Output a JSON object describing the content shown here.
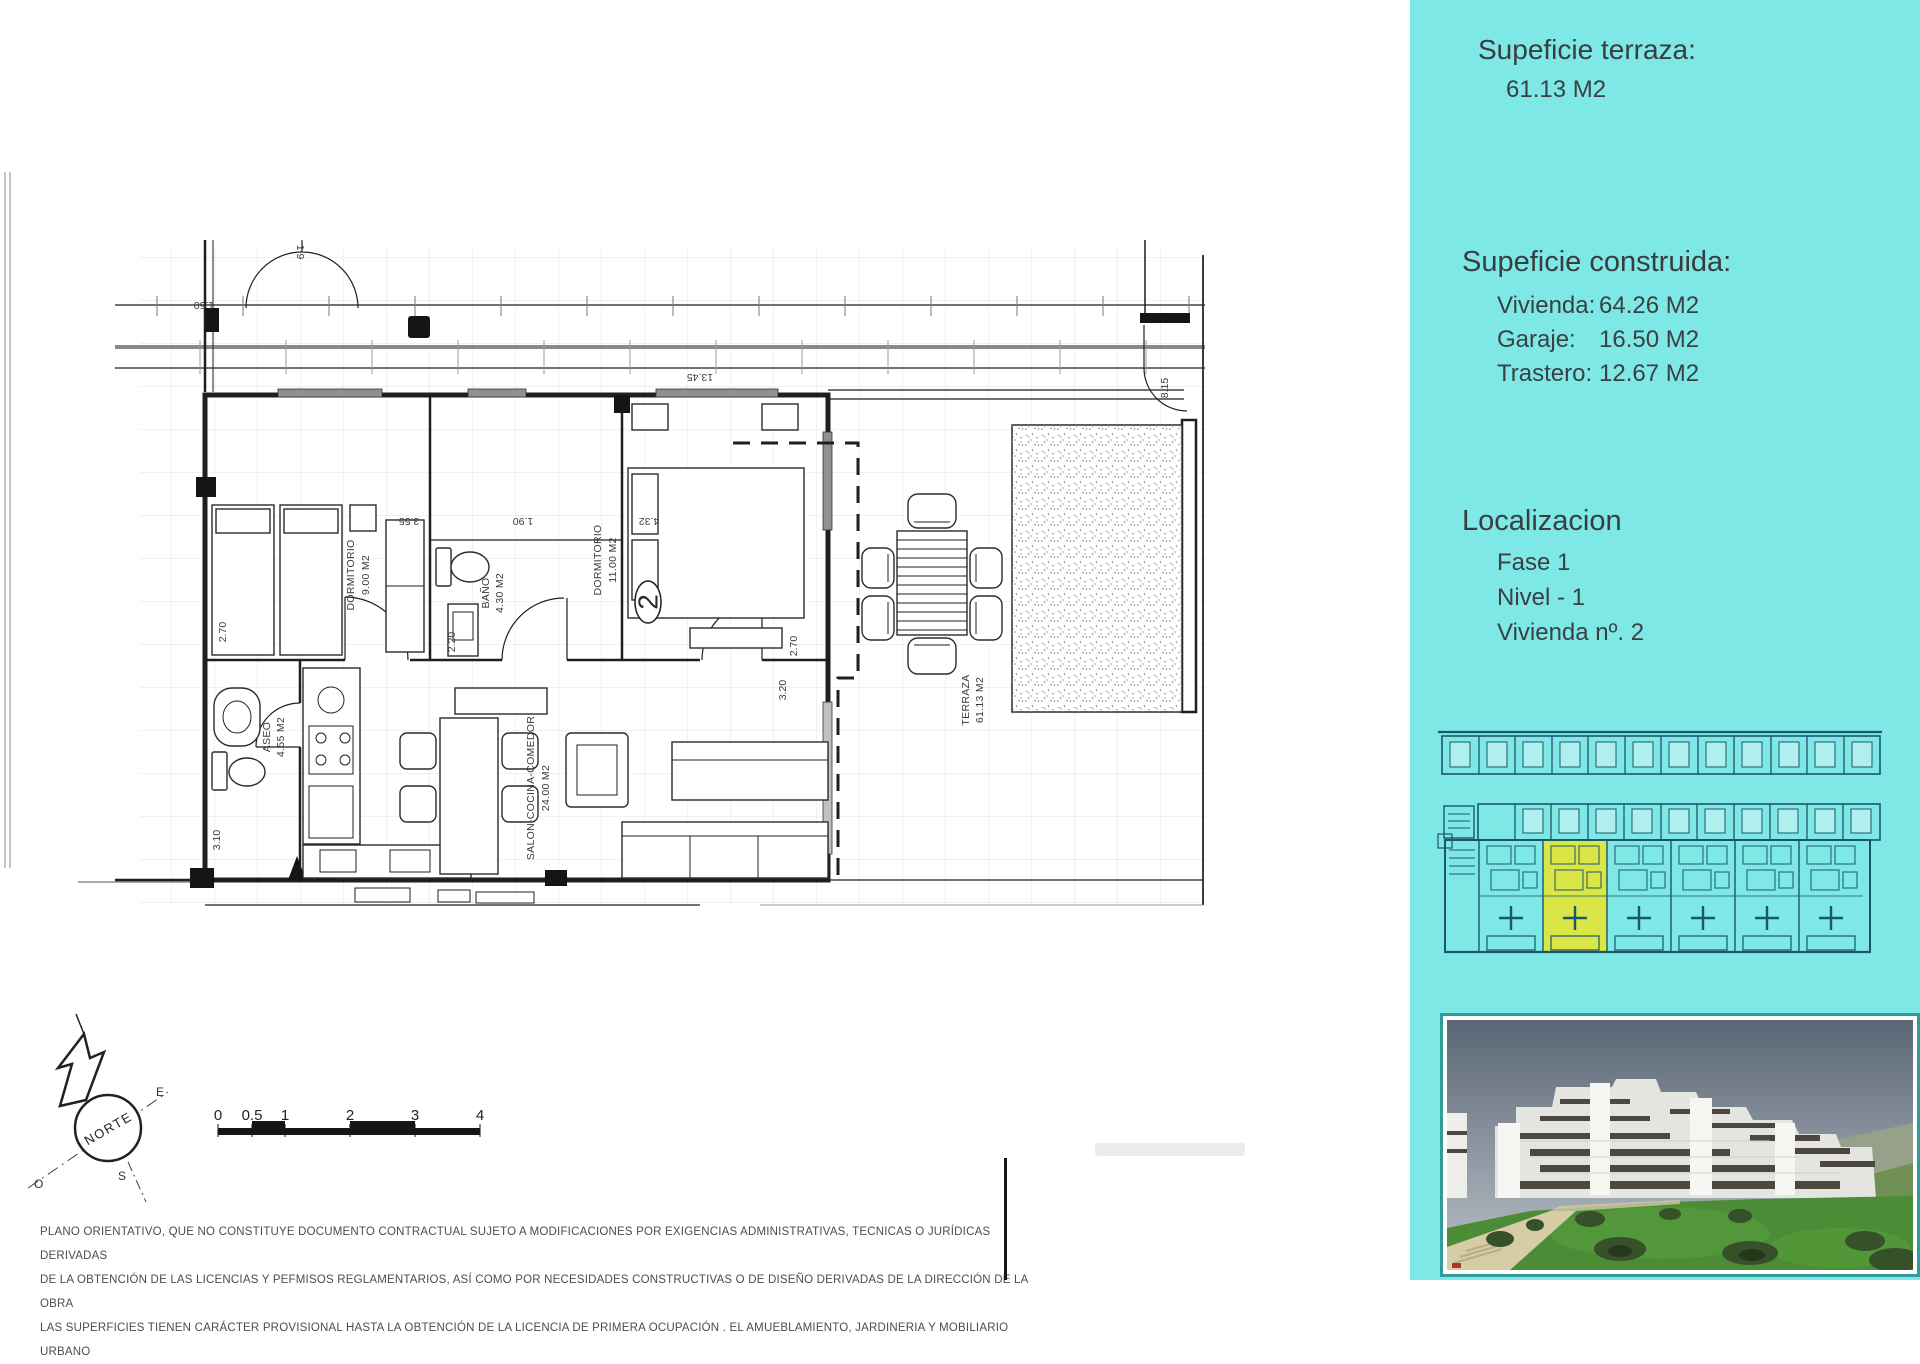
{
  "colors": {
    "sidebar_bg": "#7de8e6",
    "siteplan_line": "#1d566b",
    "highlight_unit": "#d9e646",
    "photo_frame": "#2f9e9a",
    "plan_line": "#1f1f1f",
    "text_dark": "#3c4042"
  },
  "sidebar": {
    "terrace": {
      "title": "Supeficie terraza:",
      "value": "61.13 M2"
    },
    "built": {
      "title": "Supeficie construida:",
      "rows": [
        {
          "label": "Vivienda:",
          "value": "64.26 M2"
        },
        {
          "label": "Garaje:",
          "value": "16.50 M2"
        },
        {
          "label": "Trastero:",
          "value": "12.67 M2"
        }
      ]
    },
    "location": {
      "title": "Localizacion",
      "rows": [
        {
          "label": "Fase 1"
        },
        {
          "label": "Nivel - 1"
        },
        {
          "label": "Vivienda nº. 2"
        }
      ]
    }
  },
  "plan": {
    "rooms": {
      "dormitorio1": {
        "name": "DORMITORIO",
        "area": "9.00 M2"
      },
      "bano": {
        "name": "BAÑO",
        "area": "4.30 M2"
      },
      "dormitorio2": {
        "name": "DORMITORIO",
        "area": "11.00 M2"
      },
      "aseo": {
        "name": "ASEO",
        "area": "4.55 M2"
      },
      "salon": {
        "name": "SALON-COCINA-COMEDOR",
        "area": "24.00 M2"
      },
      "terraza": {
        "name": "TERRAZA",
        "area": "61.13 M2"
      }
    },
    "unit_number": "2",
    "dims": {
      "top": "13.45",
      "right_gate": "8.15",
      "porch_w": "1.50",
      "porch_h": "1.9",
      "dorm1_w": "3.55",
      "bano_w": "1.90",
      "dorm2_w": "4.32",
      "left_h": "2.70",
      "dorm2_h": "2.70",
      "salon_win": "3.20",
      "bano_h": "2.20",
      "garage_h": "3.10"
    }
  },
  "north": {
    "label": "NORTE",
    "e": "E",
    "o": "O",
    "s": "S"
  },
  "scalebar": {
    "t0": "0",
    "t05": "0.5",
    "t1": "1",
    "t2": "2",
    "t3": "3",
    "t4": "4"
  },
  "disclaimer": {
    "line1": "PLANO ORIENTATIVO, QUE NO CONSTITUYE DOCUMENTO CONTRACTUAL SUJETO A MODIFICACIONES POR EXIGENCIAS ADMINISTRATIVAS, TECNICAS O JURÍDICAS DERIVADAS",
    "line2": "DE LA OBTENCIÓN DE LAS LICENCIAS Y PEFMISOS REGLAMENTARIOS, ASÍ COMO POR NECESIDADES CONSTRUCTIVAS  O DE DISEÑO DERIVADAS DE LA DIRECCIÓN DE LA OBRA",
    "line3": "LAS SUPERFICIES TIENEN CARÁCTER PROVISIONAL HASTA LA OBTENCIÓN DE LA LICENCIA DE PRIMERA OCUPACIÓN . EL AMUEBLAMIENTO, JARDINERIA Y MOBILIARIO URBANO"
  }
}
